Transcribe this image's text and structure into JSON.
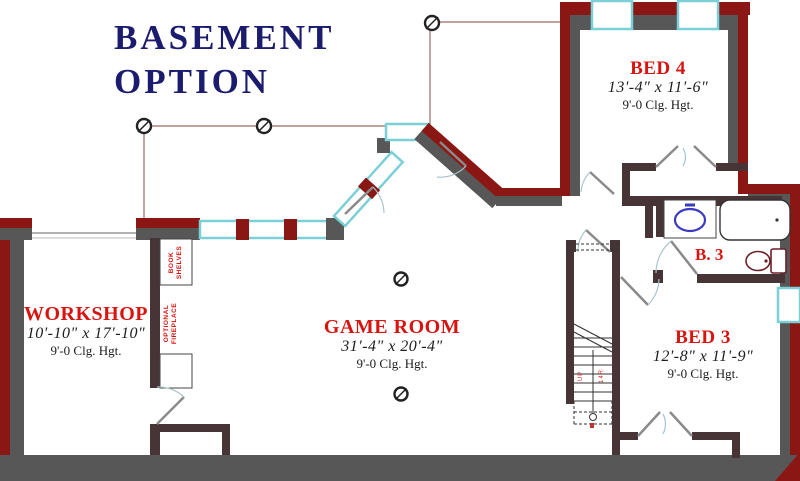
{
  "title": {
    "line1": "BASEMENT",
    "line2": "OPTION"
  },
  "rooms": {
    "workshop": {
      "name": "WORKSHOP",
      "dimensions": "10'-10\" x 17'-10\"",
      "ceiling": "9'-0 Clg. Hgt."
    },
    "game_room": {
      "name": "GAME ROOM",
      "dimensions": "31'-4\" x 20'-4\"",
      "ceiling": "9'-0 Clg. Hgt."
    },
    "bed4": {
      "name": "BED 4",
      "dimensions": "13'-4\" x 11'-6\"",
      "ceiling": "9'-0 Clg. Hgt."
    },
    "bed3": {
      "name": "BED 3",
      "dimensions": "12'-8\" x 11'-9\"",
      "ceiling": "9'-0 Clg. Hgt."
    },
    "bath3": {
      "name": "B. 3"
    }
  },
  "annotations": {
    "bookshelves": [
      "BOOK",
      "SHELVES"
    ],
    "fireplace": [
      "OPTIONAL",
      "FIREPLACE"
    ],
    "stair_marks": [
      "UP",
      "14R"
    ]
  },
  "colors": {
    "wall_exterior": "#8a1713",
    "wall_inner_gray": "#575757",
    "wall_interior": "#463436",
    "window_frame": "#7ad0d6",
    "label_red": "#d81410",
    "title_navy": "#1c1c6e"
  }
}
